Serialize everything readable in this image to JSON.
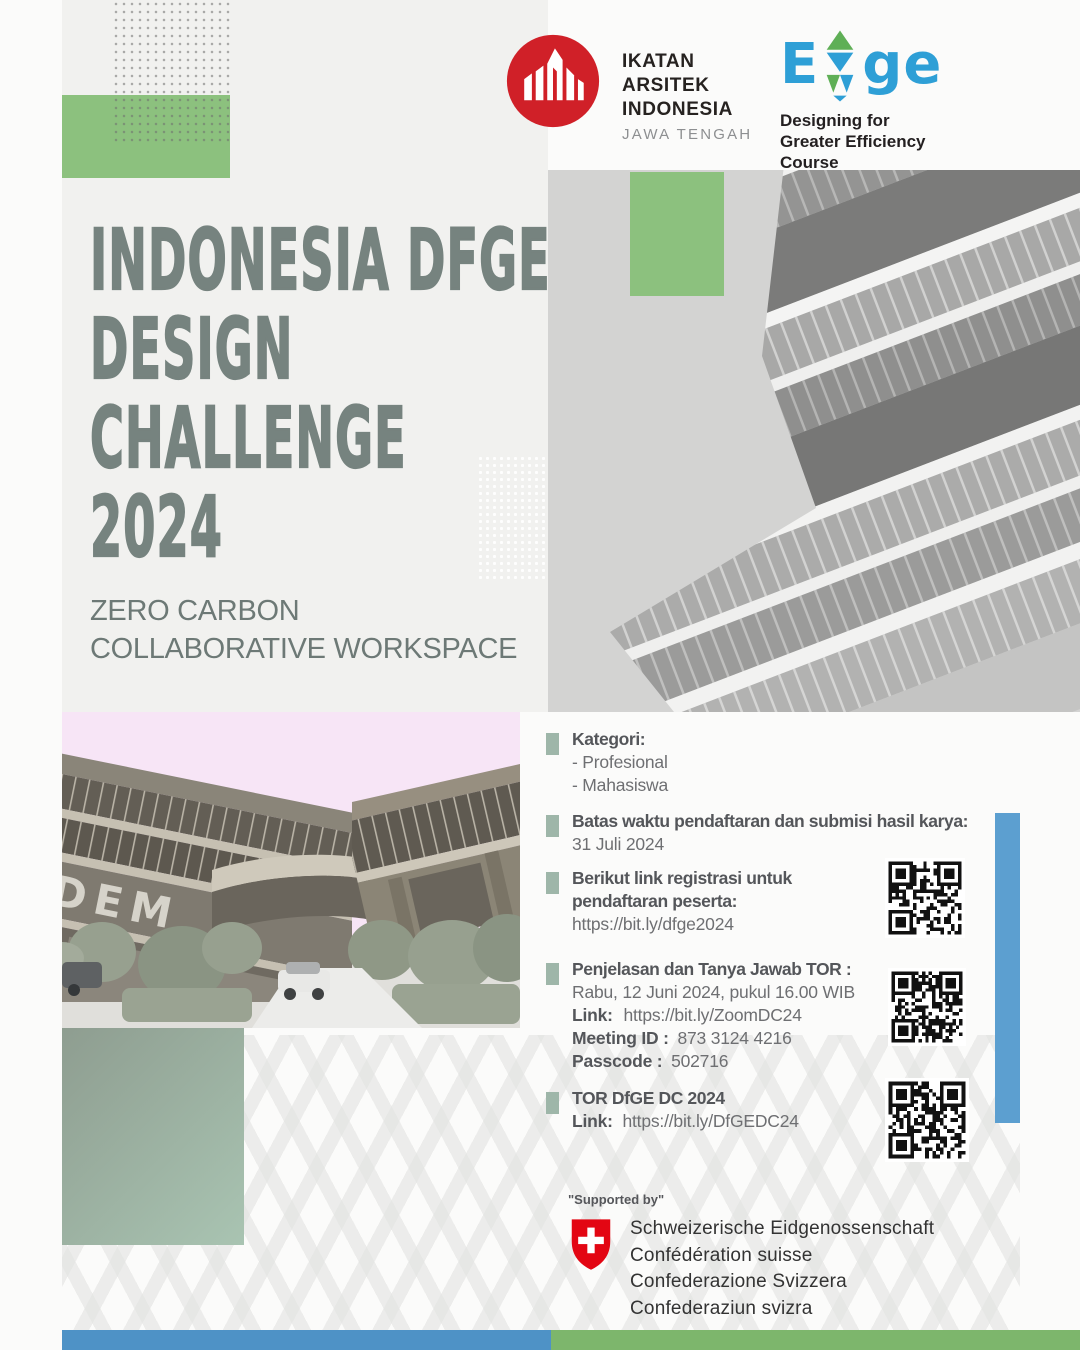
{
  "colors": {
    "green_rect": "#8cc17e",
    "sage_bullet": "#9eb6a9",
    "sage_rect_from": "#8e9d90",
    "sage_rect_to": "#a9c4b2",
    "bar_blue": "#4e92c6",
    "bar_green": "#7db66c",
    "side_bar_blue": "#5c9fd0",
    "title_color": "#76837f",
    "iai_red": "#d02028",
    "edge_blue": "#2e9fd6",
    "edge_green": "#5faf56"
  },
  "header": {
    "iai": {
      "line1": "IKATAN",
      "line2": "ARSITEK",
      "line3": "INDONESIA",
      "region": "JAWA TENGAH"
    },
    "edge": {
      "e": "E",
      "ge": "ge",
      "tag1": "Designing for",
      "tag2": "Greater Efficiency",
      "tag3": "Course"
    }
  },
  "title": {
    "line1": "INDONESIA DFGE",
    "line2": "DESIGN",
    "line3": "CHALLENGE",
    "line4": "2024"
  },
  "subtitle": {
    "line1": "ZERO CARBON",
    "line2": "COLLABORATIVE WORKSPACE"
  },
  "sections": {
    "kategori": {
      "heading": "Kategori:",
      "item1": "- Profesional",
      "item2": "- Mahasiswa"
    },
    "deadline": {
      "heading": "Batas waktu pendaftaran dan submisi hasil karya:",
      "date": "31 Juli 2024"
    },
    "registration": {
      "heading1": "Berikut link registrasi untuk",
      "heading2": "pendaftaran peserta:",
      "url": "https://bit.ly/dfge2024"
    },
    "tor_session": {
      "heading": "Penjelasan dan Tanya Jawab TOR :",
      "schedule": "Rabu, 12 Juni 2024, pukul 16.00 WIB",
      "link_label": "Link:",
      "link_url": "https://bit.ly/ZoomDC24",
      "meeting_label": "Meeting ID :",
      "meeting_value": "873 3124 4216",
      "passcode_label": "Passcode :",
      "passcode_value": "502716"
    },
    "tor_doc": {
      "heading": "TOR DfGE DC 2024",
      "link_label": "Link:",
      "link_url": "https://bit.ly/DfGEDC24"
    }
  },
  "building_render": {
    "sign_text": "DEM"
  },
  "supported_by": {
    "label": "\"Supported by\"",
    "line1": "Schweizerische Eidgenossenschaft",
    "line2": "Confédération suisse",
    "line3": "Confederazione Svizzera",
    "line4": "Confederaziun svizra"
  }
}
